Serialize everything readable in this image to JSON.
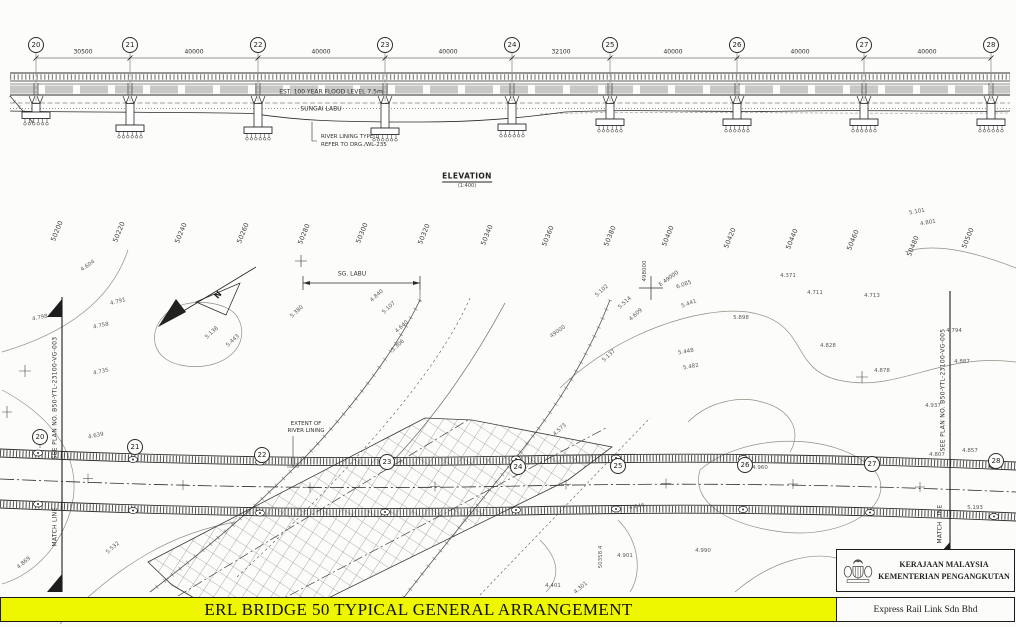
{
  "sheet": {
    "width": 1016,
    "height": 627
  },
  "colors": {
    "banner_bg": "#EEF600",
    "paper": "#FCFCFA",
    "ink": "#2B2B2B",
    "contour": "#928E84"
  },
  "banner": {
    "title": "ERL BRIDGE 50 TYPICAL GENERAL ARRANGEMENT"
  },
  "title_block": {
    "agency_line1": "KERAJAAN MALAYSIA",
    "agency_line2": "KEMENTERIAN PENGANGKUTAN",
    "company": "Express Rail Link Sdn Bhd",
    "crest": "malaysia-coat-of-arms"
  },
  "elevation": {
    "title": "ELEVATION",
    "scale": "(1:400)",
    "flood_label": "EST. 100 YEAR FLOOD LEVEL 7.5m",
    "river_label": "SUNGAI LABU",
    "lining_note_1": "RIVER LINING TYPE 1",
    "lining_note_2": "REFER TO DRG./WL-235"
  },
  "plan": {
    "river_dim_label": "SG. LABU",
    "extent_note_1": "EXTENT OF",
    "extent_note_2": "RIVER LINING",
    "north_label": "N",
    "match_left_plan": "SEE PLAN NO. B50-YTL-23100-VG-003",
    "match_right_plan": "SEE PLAN NO. B50-YTL-23100-VG-005",
    "match_line_label": "MATCH LINE"
  },
  "bubbles": {
    "elevation": [
      {
        "no": "20",
        "x": 36,
        "y": 45
      },
      {
        "no": "21",
        "x": 130,
        "y": 45
      },
      {
        "no": "22",
        "x": 258,
        "y": 45
      },
      {
        "no": "23",
        "x": 385,
        "y": 45
      },
      {
        "no": "24",
        "x": 512,
        "y": 45
      },
      {
        "no": "25",
        "x": 610,
        "y": 45
      },
      {
        "no": "26",
        "x": 737,
        "y": 45
      },
      {
        "no": "27",
        "x": 864,
        "y": 45
      },
      {
        "no": "28",
        "x": 991,
        "y": 45
      }
    ],
    "plan": [
      {
        "no": "20",
        "x": 40,
        "y": 437
      },
      {
        "no": "21",
        "x": 135,
        "y": 447
      },
      {
        "no": "22",
        "x": 262,
        "y": 455
      },
      {
        "no": "23",
        "x": 387,
        "y": 462
      },
      {
        "no": "24",
        "x": 518,
        "y": 467
      },
      {
        "no": "25",
        "x": 618,
        "y": 466
      },
      {
        "no": "26",
        "x": 745,
        "y": 465
      },
      {
        "no": "27",
        "x": 872,
        "y": 464
      },
      {
        "no": "28",
        "x": 996,
        "y": 461
      }
    ]
  },
  "label_groups": [
    {
      "name": "span-dimension",
      "cls": "dim",
      "items": [
        {
          "t": "30500",
          "x": 83,
          "y": 52
        },
        {
          "t": "40000",
          "x": 194,
          "y": 52
        },
        {
          "t": "40000",
          "x": 321,
          "y": 52
        },
        {
          "t": "40000",
          "x": 448,
          "y": 52
        },
        {
          "t": "32100",
          "x": 561,
          "y": 52
        },
        {
          "t": "40000",
          "x": 673,
          "y": 52
        },
        {
          "t": "40000",
          "x": 800,
          "y": 52
        },
        {
          "t": "40000",
          "x": 927,
          "y": 52
        }
      ]
    },
    {
      "name": "chainage-label",
      "cls": "chain",
      "items": [
        {
          "t": "50200",
          "x": 57,
          "y": 231,
          "r": -68
        },
        {
          "t": "50220",
          "x": 119,
          "y": 232,
          "r": -68
        },
        {
          "t": "50240",
          "x": 181,
          "y": 233,
          "r": -68
        },
        {
          "t": "50260",
          "x": 243,
          "y": 233,
          "r": -68
        },
        {
          "t": "50280",
          "x": 304,
          "y": 234,
          "r": -68
        },
        {
          "t": "50300",
          "x": 362,
          "y": 233,
          "r": -68
        },
        {
          "t": "50320",
          "x": 424,
          "y": 234,
          "r": -68
        },
        {
          "t": "50340",
          "x": 487,
          "y": 235,
          "r": -68
        },
        {
          "t": "50360",
          "x": 548,
          "y": 236,
          "r": -68
        },
        {
          "t": "50380",
          "x": 610,
          "y": 236,
          "r": -68
        },
        {
          "t": "50400",
          "x": 668,
          "y": 236,
          "r": -68
        },
        {
          "t": "50420",
          "x": 730,
          "y": 238,
          "r": -68
        },
        {
          "t": "50440",
          "x": 792,
          "y": 239,
          "r": -68
        },
        {
          "t": "50460",
          "x": 853,
          "y": 240,
          "r": -68
        },
        {
          "t": "50480",
          "x": 913,
          "y": 246,
          "r": -68
        },
        {
          "t": "50500",
          "x": 968,
          "y": 238,
          "r": -68
        }
      ]
    },
    {
      "name": "grid-reference",
      "cls": "gridref",
      "items": [
        {
          "t": "498000",
          "x": 645,
          "y": 271,
          "r": -90
        },
        {
          "t": "E 49000",
          "x": 669,
          "y": 279,
          "r": -36
        }
      ]
    },
    {
      "name": "spot-level",
      "cls": "spot",
      "items": [
        {
          "t": "4.604",
          "x": 88,
          "y": 266,
          "r": -35
        },
        {
          "t": "4.791",
          "x": 118,
          "y": 302,
          "r": -15
        },
        {
          "t": "4.758",
          "x": 101,
          "y": 326,
          "r": -12
        },
        {
          "t": "4.735",
          "x": 101,
          "y": 372,
          "r": -12
        },
        {
          "t": "4.639",
          "x": 96,
          "y": 436,
          "r": -12
        },
        {
          "t": "4.798",
          "x": 40,
          "y": 318,
          "r": -12
        },
        {
          "t": "4.869",
          "x": 24,
          "y": 563,
          "r": -40
        },
        {
          "t": "5.532",
          "x": 113,
          "y": 548,
          "r": -40
        },
        {
          "t": "5.138",
          "x": 212,
          "y": 333,
          "r": -42
        },
        {
          "t": "5.443",
          "x": 233,
          "y": 341,
          "r": -42
        },
        {
          "t": "5.380",
          "x": 297,
          "y": 312,
          "r": -42
        },
        {
          "t": "4.840",
          "x": 377,
          "y": 296,
          "r": -42
        },
        {
          "t": "5.107",
          "x": 389,
          "y": 308,
          "r": -42
        },
        {
          "t": "4.640",
          "x": 402,
          "y": 327,
          "r": -42
        },
        {
          "t": "5.306",
          "x": 398,
          "y": 346,
          "r": -42
        },
        {
          "t": "49000",
          "x": 558,
          "y": 332,
          "r": -35
        },
        {
          "t": "5.102",
          "x": 602,
          "y": 291,
          "r": -42
        },
        {
          "t": "5.514",
          "x": 625,
          "y": 303,
          "r": -42
        },
        {
          "t": "4.609",
          "x": 636,
          "y": 315,
          "r": -42
        },
        {
          "t": "6.085",
          "x": 684,
          "y": 285,
          "r": -20
        },
        {
          "t": "5.441",
          "x": 689,
          "y": 304,
          "r": -20
        },
        {
          "t": "5.898",
          "x": 741,
          "y": 318,
          "r": 0
        },
        {
          "t": "5.448",
          "x": 686,
          "y": 352,
          "r": -10
        },
        {
          "t": "5.482",
          "x": 691,
          "y": 367,
          "r": -10
        },
        {
          "t": "5.137",
          "x": 609,
          "y": 356,
          "r": -42
        },
        {
          "t": "4.573",
          "x": 560,
          "y": 430,
          "r": -42
        },
        {
          "t": "4.371",
          "x": 788,
          "y": 276,
          "r": 0
        },
        {
          "t": "4.711",
          "x": 815,
          "y": 293,
          "r": 0
        },
        {
          "t": "4.713",
          "x": 872,
          "y": 296,
          "r": 0
        },
        {
          "t": "5.101",
          "x": 917,
          "y": 212,
          "r": -10
        },
        {
          "t": "4.801",
          "x": 928,
          "y": 223,
          "r": -10
        },
        {
          "t": "4.828",
          "x": 828,
          "y": 346,
          "r": 0
        },
        {
          "t": "4.878",
          "x": 882,
          "y": 371,
          "r": 0
        },
        {
          "t": "4.937",
          "x": 933,
          "y": 406,
          "r": 0
        },
        {
          "t": "4.807",
          "x": 937,
          "y": 455,
          "r": 0
        },
        {
          "t": "4.794",
          "x": 954,
          "y": 331,
          "r": 0
        },
        {
          "t": "4.887",
          "x": 962,
          "y": 362,
          "r": 0
        },
        {
          "t": "4.857",
          "x": 970,
          "y": 451,
          "r": 0
        },
        {
          "t": "5.193",
          "x": 975,
          "y": 508,
          "r": 0
        },
        {
          "t": "4.960",
          "x": 760,
          "y": 468,
          "r": 0
        },
        {
          "t": "4.646",
          "x": 637,
          "y": 507,
          "r": -10
        },
        {
          "t": "4.990",
          "x": 703,
          "y": 551,
          "r": 0
        },
        {
          "t": "4.901",
          "x": 625,
          "y": 556,
          "r": 0
        },
        {
          "t": "4.401",
          "x": 553,
          "y": 586,
          "r": 0
        },
        {
          "t": "4.301",
          "x": 581,
          "y": 588,
          "r": -40
        },
        {
          "t": "50358.4",
          "x": 601,
          "y": 557,
          "r": -90
        }
      ]
    }
  ]
}
